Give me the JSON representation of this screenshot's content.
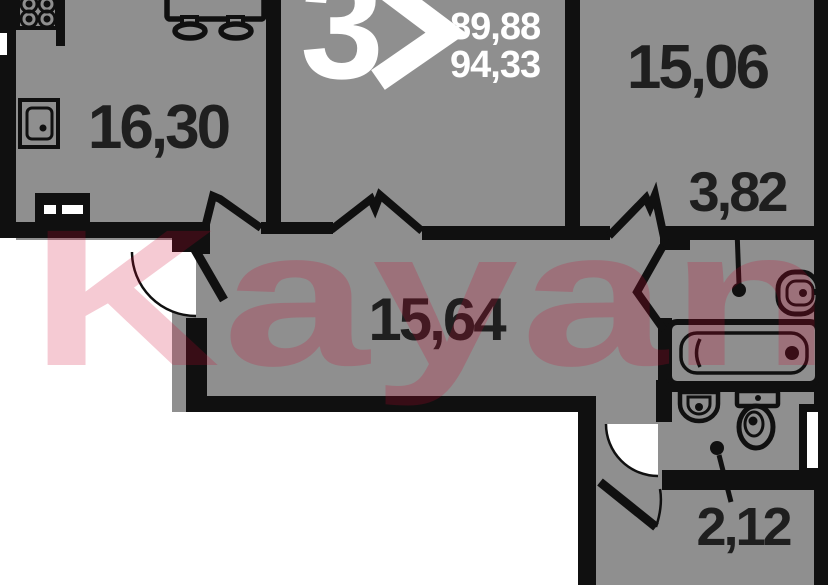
{
  "plan": {
    "type": "apartment-floor-plan",
    "badge": {
      "room_count": "3",
      "area_1": "89,88",
      "area_2": "94,33"
    },
    "rooms": [
      {
        "name": "kitchen-living-room",
        "area": "16,30"
      },
      {
        "name": "bedroom",
        "area": "15,06"
      },
      {
        "name": "hallway",
        "area": "3,82"
      },
      {
        "name": "corridor",
        "area": "15,64"
      },
      {
        "name": "wc",
        "area": "2,12"
      }
    ]
  },
  "watermark": {
    "text": "Kayan"
  },
  "colors": {
    "floor": "#8f8f8f",
    "wall": "#101010",
    "outside": "#ffffff",
    "label": "#1f1f1f",
    "badge": "#ffffff",
    "watermark": "#d2052d"
  }
}
